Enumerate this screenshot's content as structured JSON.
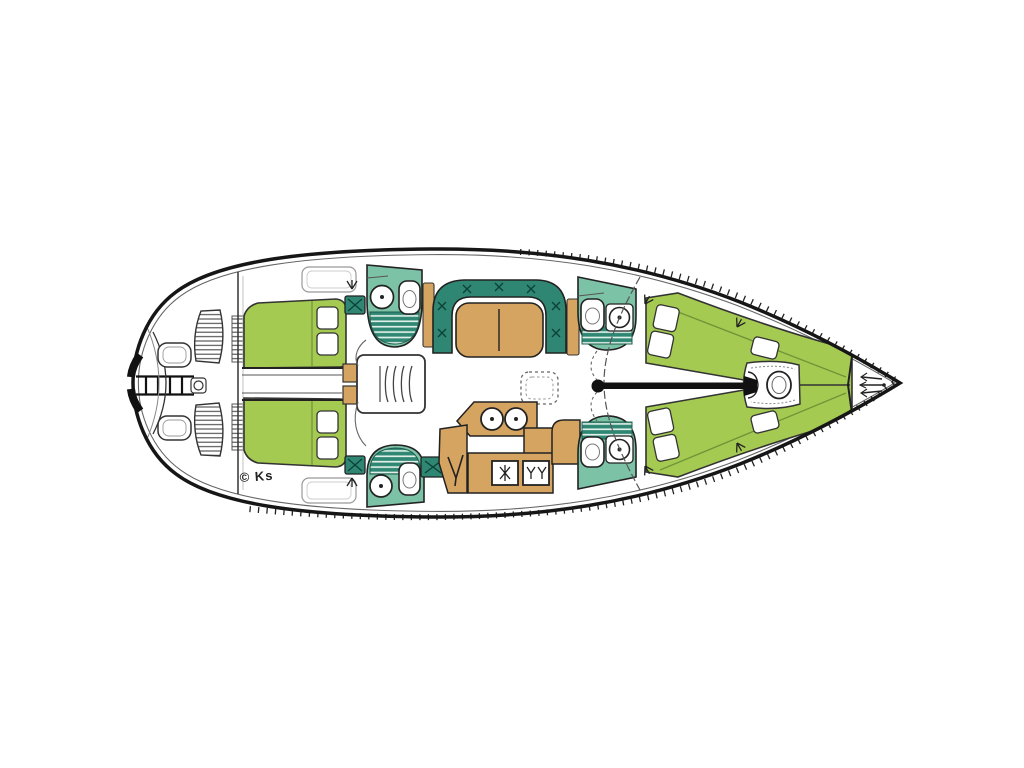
{
  "diagram": {
    "watermark": "© Ks"
  },
  "colors": {
    "background": "#ffffff",
    "hull-line": "#161616",
    "berth-green": "#a5ca52",
    "berth-green-seam": "#6f9437",
    "head-teal": "#7cc2a6",
    "settee-teal": "#2f8673",
    "wood-tan": "#d5a461",
    "detail-line": "#333333"
  }
}
